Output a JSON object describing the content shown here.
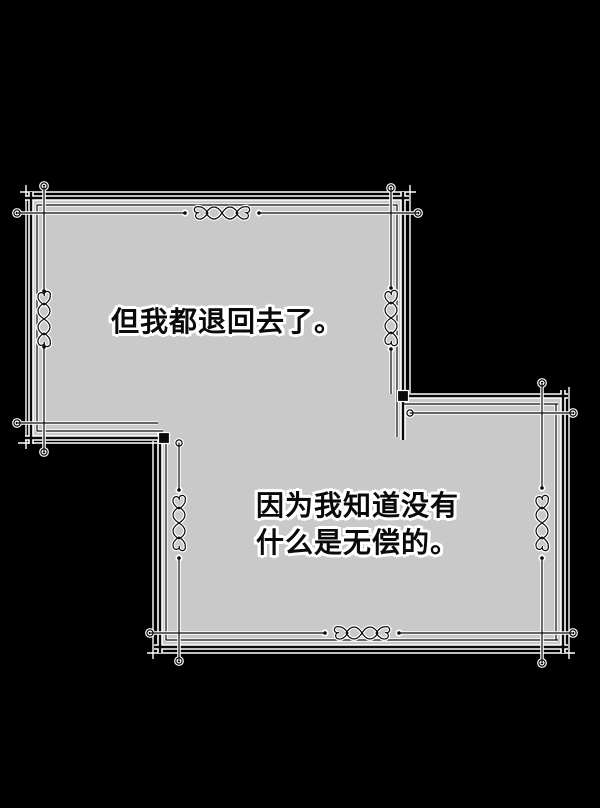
{
  "scene": {
    "background_color": "#000000",
    "panel_fill": "#c9c9c9",
    "ink_color": "#0a0a0a",
    "casing_color": "#ffffff"
  },
  "panels": [
    {
      "label": "top-left narration panel",
      "text": "但我都退回去了。"
    },
    {
      "label": "bottom-right narration panel",
      "text_line1": "因为我知道没有",
      "text_line2": "什么是无偿的。"
    }
  ]
}
